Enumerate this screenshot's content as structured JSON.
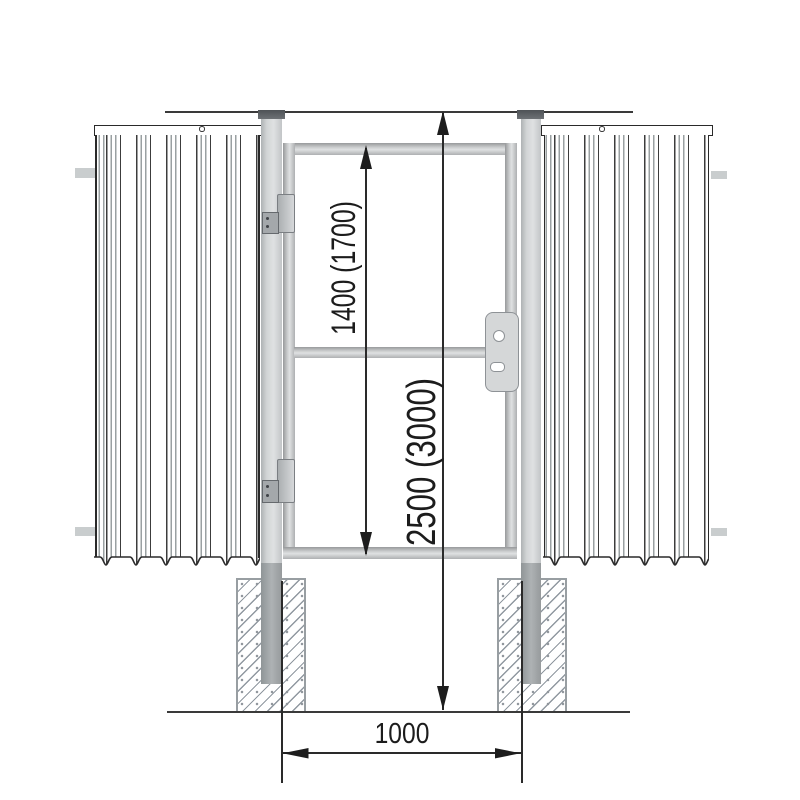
{
  "labels": {
    "gate_height": "1400 (1700)",
    "post_length": "2500 (3000)",
    "opening_width": "1000"
  },
  "colors": {
    "line": "#2a2a2a",
    "metal_light": "#dfe1e2",
    "metal_dark": "#97999b",
    "post_cap": "#54585c",
    "concrete_hatch": "#9098a0",
    "stub": "#c9cdce"
  }
}
